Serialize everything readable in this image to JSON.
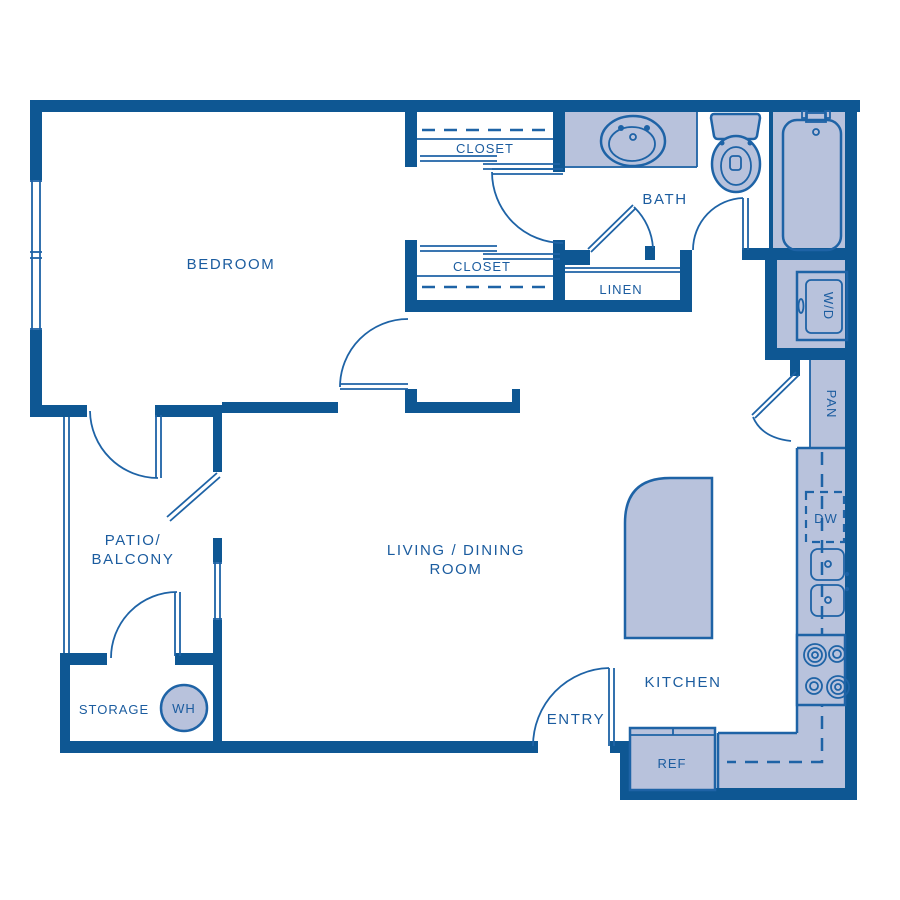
{
  "title": "One-bedroom apartment floor plan",
  "colors": {
    "wall": "#0E5793",
    "line": "#1E63A6",
    "fill": "#B8C2DC",
    "text": "#1B5C9F"
  },
  "labels": {
    "bedroom": "BEDROOM",
    "closet_top": "CLOSET",
    "closet_mid": "CLOSET",
    "bath": "BATH",
    "linen": "LINEN",
    "washer_dryer": "W/D",
    "pantry": "PAN",
    "dishwasher": "DW",
    "patio_line1": "PATIO/",
    "patio_line2": "BALCONY",
    "living_line1": "LIVING / DINING",
    "living_line2": "ROOM",
    "storage": "STORAGE",
    "water_heater": "WH",
    "kitchen": "KITCHEN",
    "entry": "ENTRY",
    "refrigerator": "REF"
  }
}
